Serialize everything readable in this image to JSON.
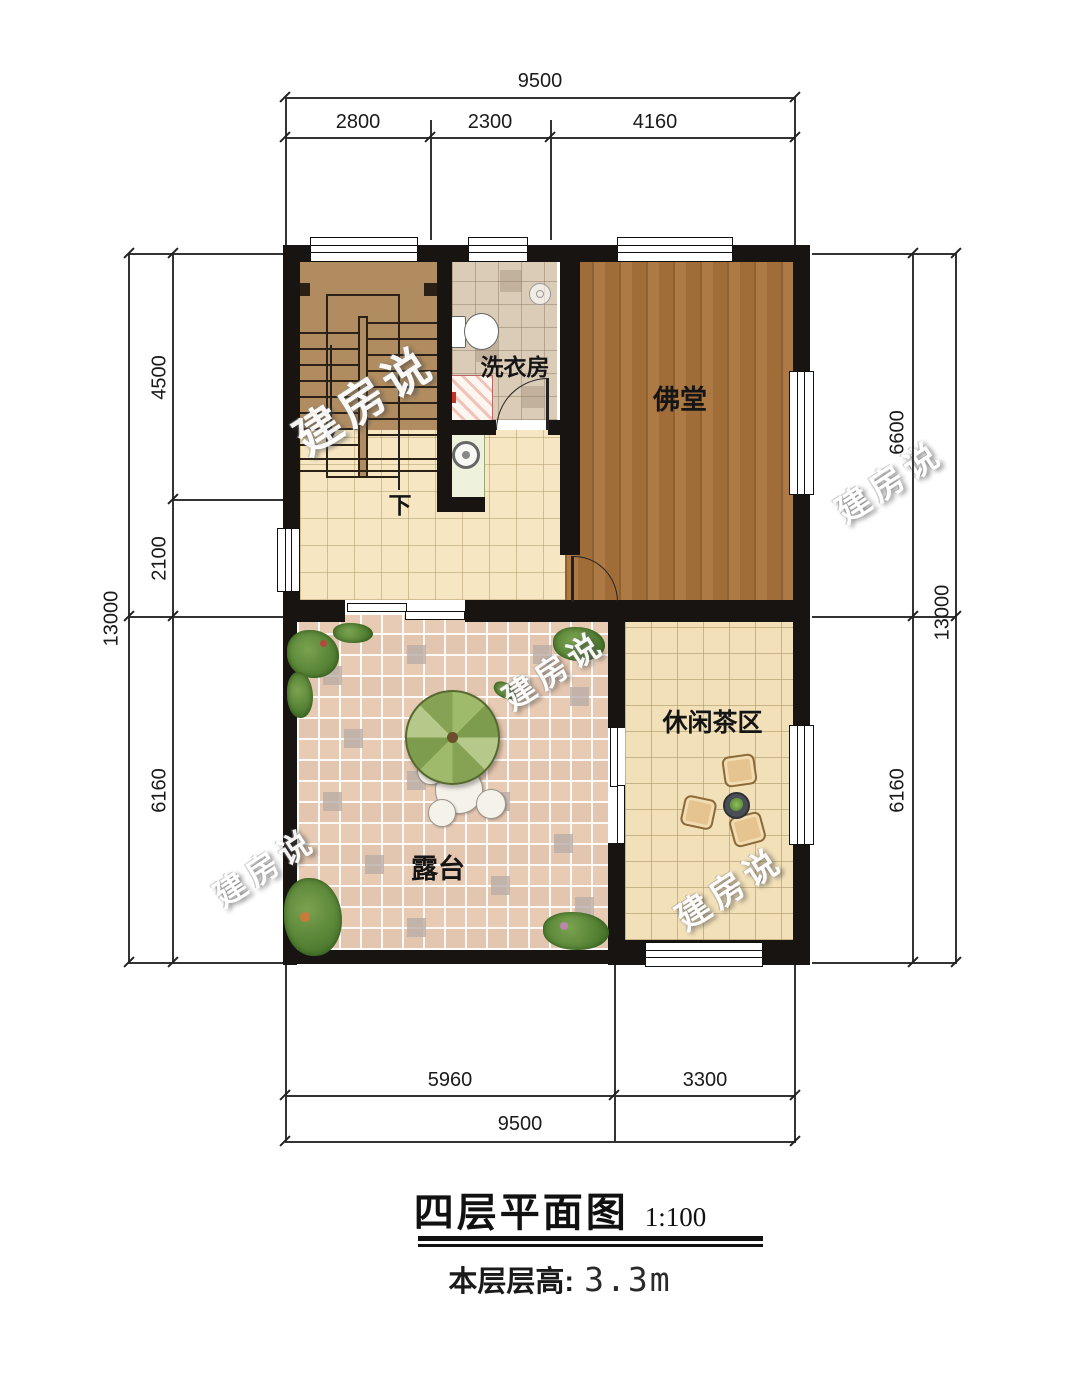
{
  "title": {
    "name": "四层平面图",
    "scale": "1:100",
    "floor_height_label": "本层层高:",
    "floor_height_value": "3.3m"
  },
  "watermark": {
    "text": "建房说"
  },
  "rooms": {
    "laundry": "洗衣房",
    "buddhist_hall": "佛堂",
    "tea_area": "休闲茶区",
    "terrace": "露台",
    "stairs_down": "下"
  },
  "dimensions": {
    "top": {
      "total": "9500",
      "segments": [
        "2800",
        "2300",
        "4160"
      ]
    },
    "bottom": {
      "total": "9500",
      "segments": [
        "5960",
        "3300"
      ]
    },
    "left": {
      "total": "13000",
      "segments": [
        "4500",
        "2100",
        "6160"
      ]
    },
    "right": {
      "total": "13000",
      "segments": [
        "6600",
        "6160"
      ]
    }
  },
  "colors": {
    "wall": "#181411",
    "hall_wood": "#a06d38",
    "stair_wood": "#b08c60",
    "terrace_tile": "#e7ccb5",
    "cream_tile": "#f6e7c2",
    "umbrella_green": "#8fae5c"
  }
}
